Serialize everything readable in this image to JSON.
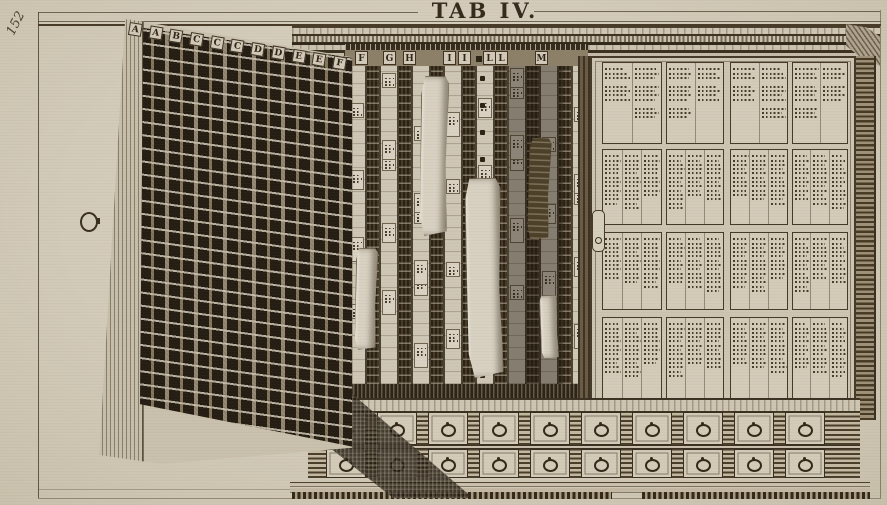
{
  "plate": {
    "title": "TAB IV.",
    "page_number": "152"
  },
  "cabinet": {
    "door_letters": [
      "A",
      "A",
      "B",
      "C",
      "C",
      "C",
      "D",
      "D",
      "E",
      "E",
      "F"
    ],
    "interior_letters": [
      "F",
      "G",
      "H",
      "I",
      "I",
      "·",
      "L",
      "L",
      "M"
    ],
    "right_door": {
      "panel_rows": 4,
      "panel_cols": 4,
      "keyhole_icon": "keyhole-icon"
    },
    "drawers": {
      "rows": 2,
      "per_row": 10,
      "pull_icon": "ring-pull-icon"
    },
    "specimen_sheets": 5,
    "colors": {
      "paper": "#d3cbba",
      "ink": "#33291b",
      "dark_wood": "#463a27",
      "shadow": "#241d12"
    }
  }
}
